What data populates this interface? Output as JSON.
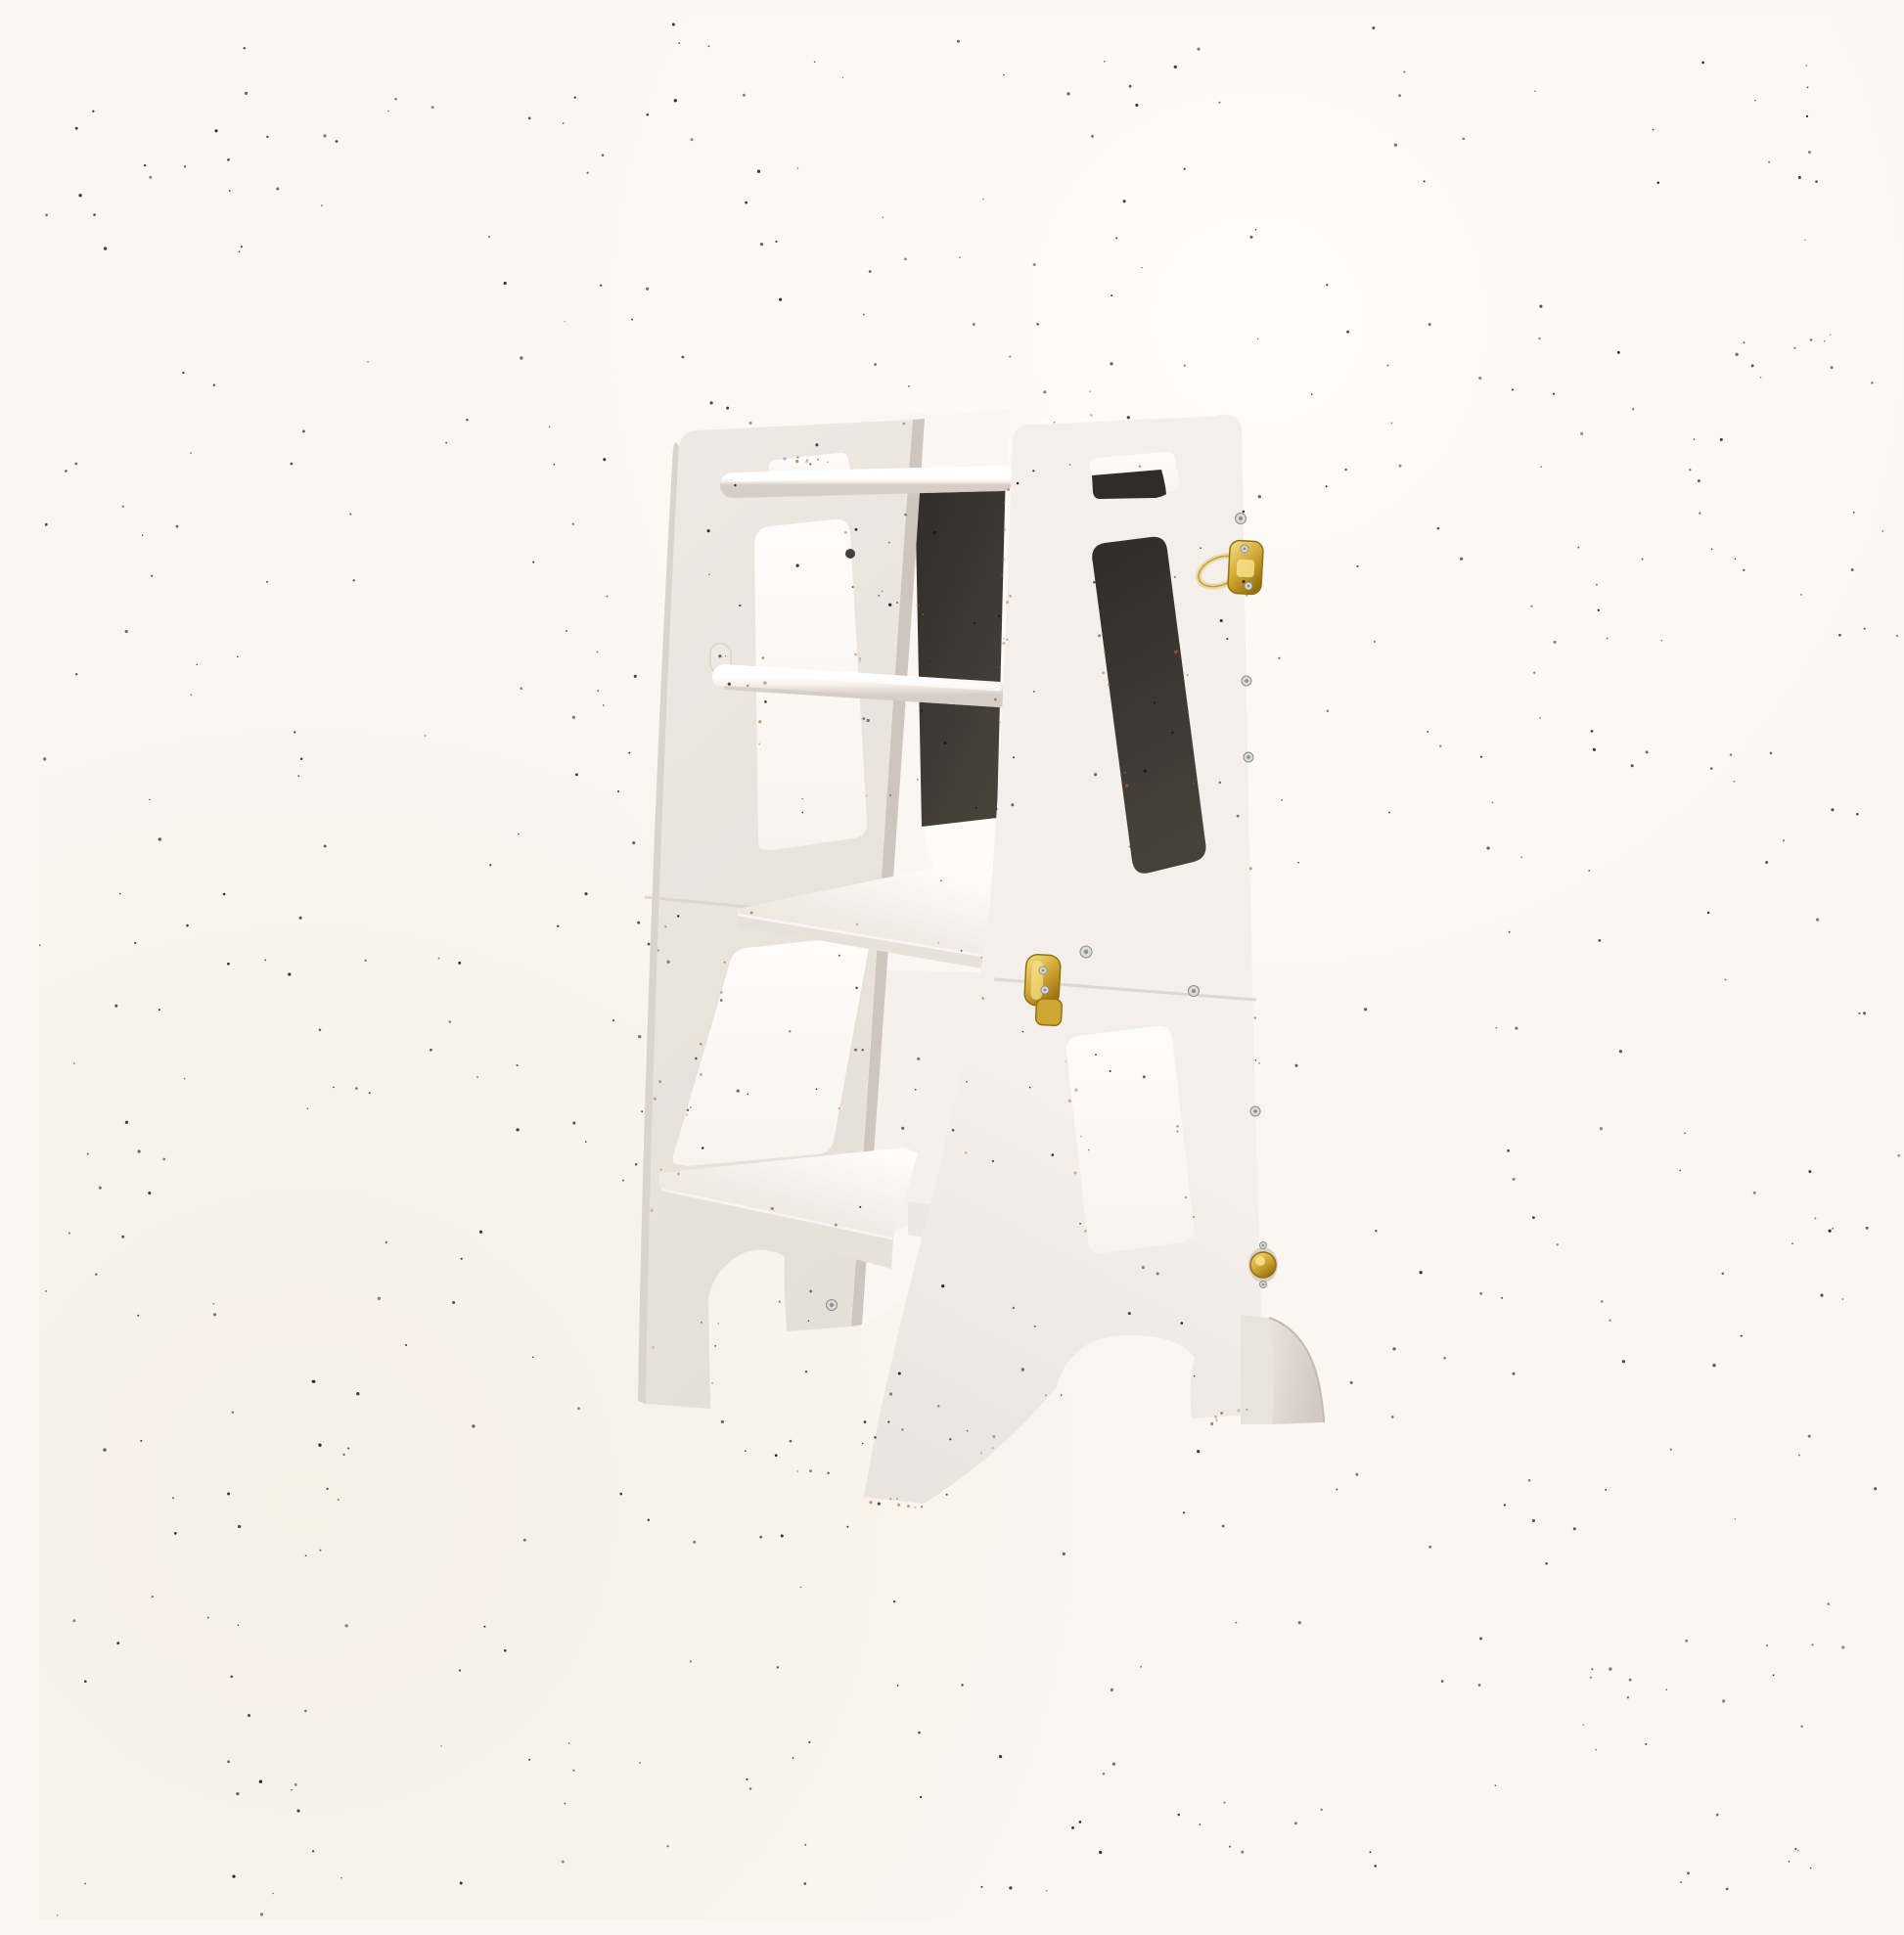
{
  "scene": {
    "type": "product-photo",
    "alt": "White wooden Montessori learning tower step stool with a black chalkboard panel, two round handrails, a standing platform, a lower step and brass latches, photographed on a plain speckled cream studio background",
    "background_style": "plain cream studio backdrop with fine dark speckle noise"
  },
  "product": {
    "name": "learning-tower-step-stool",
    "finish": "white painted plywood",
    "hardware_finish": "brass",
    "parts": {
      "left_panel": "left side panel with carry-handle cutout and two window cutouts",
      "right_panel": "right side panel with carry-handle cutout, chalkboard window and lower window",
      "chalkboard": "black chalkboard back panel",
      "handrail_top": "upper round safety handrail",
      "handrail_mid": "middle round safety handrail",
      "platform": "adjustable standing platform",
      "step": "lower climbing step",
      "rear_shelf": "lower rear shelf board",
      "foot": "quarter-round anti-tip foot support",
      "latch_top": "brass toggle latch on upper right edge",
      "latch_mid": "brass fold latch at middle seam",
      "knob": "brass knob on lower right edge",
      "seam": "fold seam between upper and lower panel halves",
      "screws": "silver assembly screws"
    }
  },
  "palette": {
    "bg": "#FBF6F0",
    "bgGlow": "#FFFDFA",
    "bgShade": "#F3EAE0",
    "panelLight": "#F4EFEA",
    "panelLightDeep": "#EAE3DD",
    "panelFar": "#EFE9E3",
    "panelFarDeep": "#E6DFD8",
    "edgeGrey": "#CDC5BE",
    "edgeGrey2": "#DBD4CC",
    "windowLit": "#FEFCFA",
    "windowLitDeep": "#F8F3ED",
    "interiorLit": "#FAF6F1",
    "interiorShade": "#E4DDD6",
    "chalkDark": "#2F2C2A",
    "chalkMid": "#3B3734",
    "chalkLight": "#474139",
    "railTop": "#FFFFFF",
    "railMid": "#F4EFEA",
    "railShade": "#D6CEC6",
    "goldLight": "#F6E289",
    "goldMid": "#D0A633",
    "goldDark": "#96700F",
    "goldPale": "#EBD9A0",
    "screwLight": "#D9D9D7",
    "screwDark": "#8E8E8C",
    "stepTop": "#F2ECE6",
    "stepFace": "#E8E1DA",
    "footFace": "#EAE3DC",
    "footEdge": "#D2CAC2",
    "speckle": "#171310",
    "artifactWarm": "#B06227",
    "artifactCool": "#6B86A8"
  },
  "speckles": {
    "count": 600,
    "artifact_count": 120
  }
}
